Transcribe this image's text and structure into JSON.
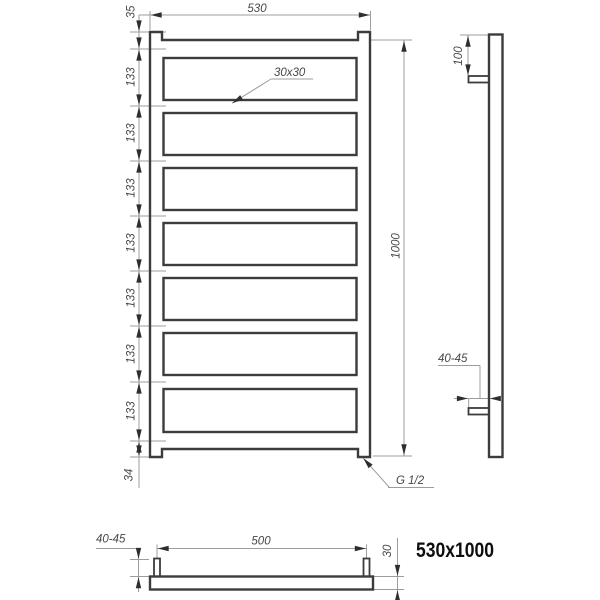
{
  "drawing_title": "530x1000",
  "front_view": {
    "width_dim": "530",
    "top_offset_dim": "35",
    "rung_spacing_dims": [
      "133",
      "133",
      "133",
      "133",
      "133",
      "133",
      "133"
    ],
    "bottom_offset_dim": "34",
    "height_dim": "1000",
    "tube_profile_callout": "30x30",
    "thread_callout": "G 1/2"
  },
  "side_view": {
    "top_bracket_offset_dim": "100",
    "wall_clearance_dim": "40-45"
  },
  "bottom_view": {
    "wall_clearance_dim": "40-45",
    "bracket_spacing_dim": "500",
    "tube_depth_dim": "30"
  },
  "colors": {
    "geometry": "#3c3c3c",
    "dimension_line": "#9c9c9c",
    "dimension_text": "#474747",
    "arrow": "#2e2e2e",
    "title_text": "#0d0d0d",
    "background": "#ffffff"
  }
}
